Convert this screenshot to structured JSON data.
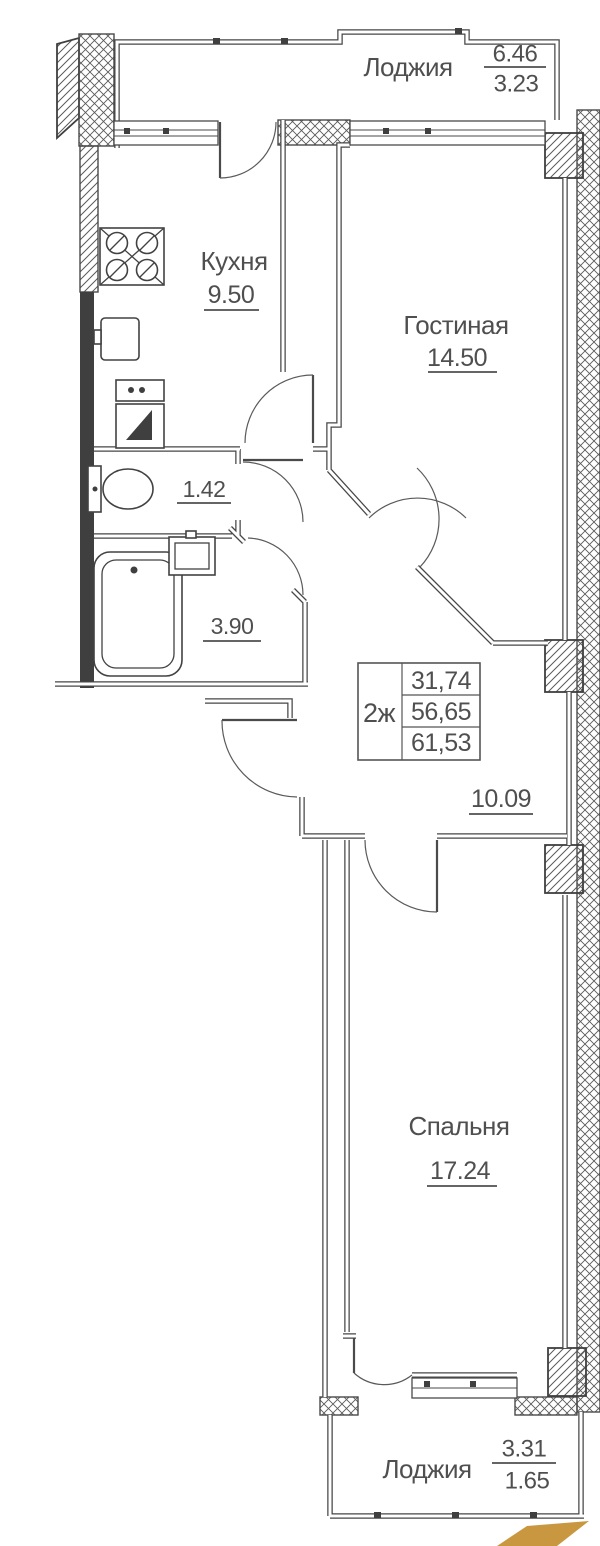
{
  "floor_plan": {
    "unit_info": {
      "unit_type": "2ж",
      "row1": "31,74",
      "row2": "56,65",
      "row3": "61,53"
    },
    "rooms": {
      "loggia_top": {
        "name": "Лоджия",
        "area_total": "6.46",
        "area_reduced": "3.23"
      },
      "kitchen": {
        "name": "Кухня",
        "area": "9.50"
      },
      "living_room": {
        "name": "Гостиная",
        "area": "14.50"
      },
      "wc": {
        "area": "1.42"
      },
      "bathroom": {
        "area": "3.90"
      },
      "hallway": {
        "area": "10.09"
      },
      "bedroom": {
        "name": "Спальня",
        "area": "17.24"
      },
      "loggia_bottom": {
        "name": "Лоджия",
        "area_total": "3.31",
        "area_reduced": "1.65"
      }
    },
    "icons": {
      "stove": "stove-icon",
      "kitchen_sink": "kitchen-sink-icon",
      "washing_machine": "washing-machine-icon",
      "toilet": "toilet-icon",
      "bathtub": "bathtub-icon",
      "wash_basin": "wash-basin-icon"
    },
    "colors": {
      "line": "#4a4a4a",
      "solid_wall": "#3f3f3f",
      "logo_gold": "#c8973f"
    }
  }
}
